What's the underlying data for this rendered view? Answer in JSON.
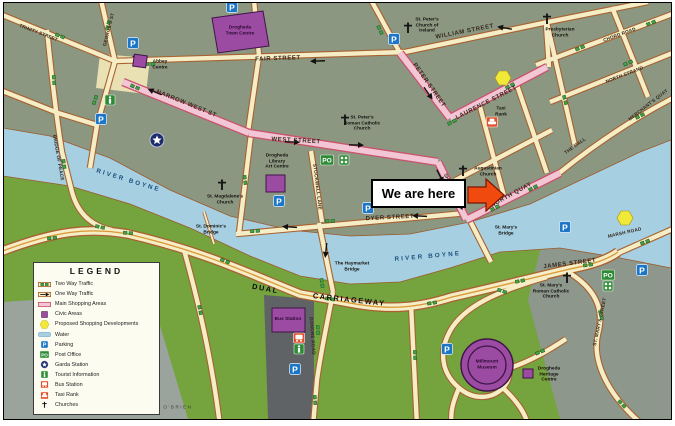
{
  "we_are_here": "We are here",
  "legend": {
    "title": "LEGEND",
    "items": [
      {
        "icon": "two-way-traffic-icon",
        "label": "Two Way Traffic"
      },
      {
        "icon": "one-way-traffic-icon",
        "label": "One Way Traffic"
      },
      {
        "icon": "main-shopping-area-icon",
        "label": "Main Shopping Areas"
      },
      {
        "icon": "civic-area-icon",
        "label": "Civic Areas"
      },
      {
        "icon": "proposed-shopping-icon",
        "label": "Proposed Shopping Developments"
      },
      {
        "icon": "water-icon",
        "label": "Water"
      },
      {
        "icon": "parking-icon",
        "label": "Parking"
      },
      {
        "icon": "post-office-icon",
        "label": "Post Office"
      },
      {
        "icon": "garda-station-icon",
        "label": "Garda Station"
      },
      {
        "icon": "tourist-information-icon",
        "label": "Tourist Information"
      },
      {
        "icon": "bus-station-icon",
        "label": "Bus Station"
      },
      {
        "icon": "taxi-rank-icon",
        "label": "Taxi Rank"
      },
      {
        "icon": "church-icon",
        "label": "Churches"
      }
    ]
  },
  "map": {
    "streets": {
      "trinity": "TRINITY STREET",
      "georges": "GEORGE'S ST",
      "fair": "FAIR STREET",
      "william": "WILLIAM STREET",
      "chord": "CHORD ROAD",
      "north_strand": "NORTH STRAND",
      "merchants_quay": "MERCHANT'S QUAY",
      "the_mall": "THE MALL",
      "peter": "PETER STREET",
      "laurence": "LAURENCE STREET",
      "narrow_west": "NARROW WEST ST",
      "west": "WEST STREET",
      "shop": "SHOP STREET",
      "stockwell": "STOCKWELL LANE",
      "dyer": "DYER STREET",
      "north_quay": "NORTH QUAY",
      "bridge_of_peace": "BRIDGE OF PEACE",
      "dual1": "DUAL",
      "dual2": "CARRIAGEWAY",
      "donore": "DONORE ROAD",
      "james": "JAMES STREET",
      "marsh": "MARSH ROAD",
      "st_marys_st": "ST. MARY'S STREET",
      "river_w": "RIVER BOYNE",
      "river_e": "RIVER BOYNE"
    },
    "places": {
      "st_peters_coi": "St. Peter's\nChurch of\nIreland",
      "presbyterian": "Presbyterian\nChurch",
      "st_peters_rc": "St. Peter's\nRoman Catholic\nChurch",
      "st_magdalenes": "St. Magdalene's\nChurch",
      "augustinian": "Augustinian\nChurch",
      "st_marys_rc": "St. Mary's\nRoman Catholic\nChurch",
      "st_marys_bridge": "St. Mary's\nBridge",
      "haymarket_bridge": "The Haymarket\nBridge",
      "dominics_bridge": "St. Dominic's\nBridge",
      "town_centre": "Drogheda\nTown Centre",
      "abbey_centre": "Abbey\nCentre",
      "library": "Drogheda\nLibrary\nArt Centre",
      "bus_station": "Bus Station",
      "taxi_rank": "Taxi\nRank",
      "millmount": "Millmount\nMuseum",
      "heritage": "Drogheda\nHeritage\nCentre",
      "copyright": "© DANIEL O'BRIEN"
    },
    "colors": {
      "town_land": "#8c9782",
      "park_green": "#75a33d",
      "river_blue": "#a6cfe2",
      "road_fill": "#f4edc6",
      "road_border": "#a8612f",
      "shopping_street": "#f2c6d5",
      "shopping_border": "#c9536b",
      "civic_purple": "#9c4ba2",
      "proposed_yellow": "#f2e838",
      "parking_blue": "#1b76c8",
      "services_green": "#2e8b35",
      "transport_red": "#e0502a",
      "highlight_arrow": "#f14a0e"
    }
  }
}
